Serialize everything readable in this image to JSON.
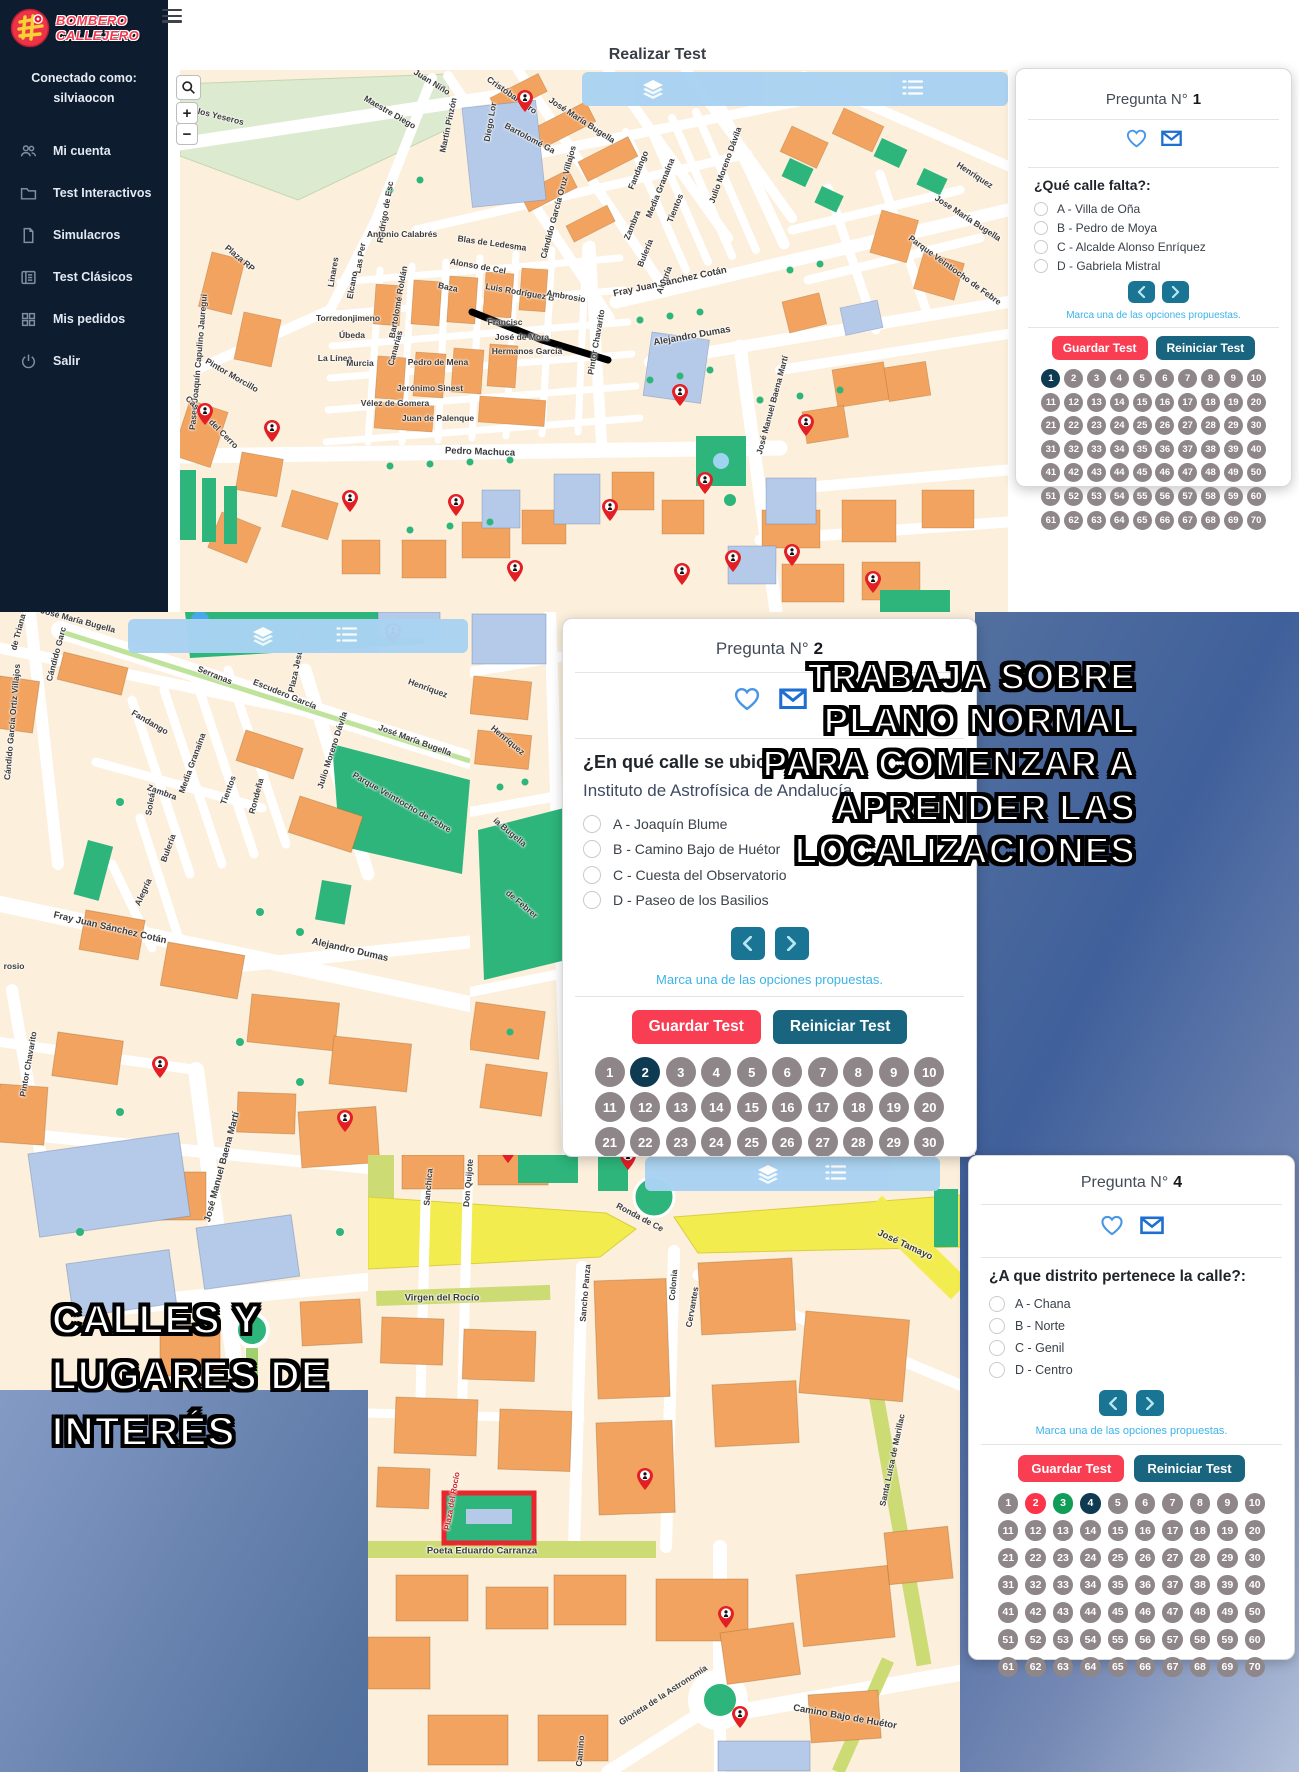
{
  "app": {
    "brand": {
      "line1": "BOMBERO",
      "line2": "CALLEJERO"
    },
    "sidebar": {
      "connected_label": "Conectado como:",
      "username": "silviaocon",
      "menu": [
        {
          "icon": "users",
          "label": "Mi cuenta"
        },
        {
          "icon": "folder",
          "label": "Test Interactivos"
        },
        {
          "icon": "file",
          "label": "Simulacros"
        },
        {
          "icon": "listalt",
          "label": "Test Clásicos"
        },
        {
          "icon": "grid",
          "label": "Mis pedidos"
        },
        {
          "icon": "power",
          "label": "Salir"
        }
      ]
    },
    "header": {
      "title": "Realizar Test"
    }
  },
  "labels": {
    "title_prefix": "Pregunta N°",
    "hint": "Marca una de las opciones propuestas.",
    "save": "Guardar Test",
    "reset": "Reiniciar Test"
  },
  "questions": {
    "q1": {
      "number": "1",
      "question": "¿Qué calle falta?:",
      "options": [
        "A - Villa de Oña",
        "B - Pedro de Moya",
        "C - Alcalde Alonso Enríquez",
        "D - Gabriela Mistral"
      ],
      "grid": {
        "total": 70,
        "states": {
          "1": "current"
        }
      }
    },
    "q2": {
      "number": "2",
      "question": "¿En qué calle se ubica?:",
      "subject": "Instituto de Astrofísica de Andalucía",
      "options": [
        "A - Joaquín Blume",
        "B - Camino Bajo de Huétor",
        "C - Cuesta del Observatorio",
        "D - Paseo de los Basilios"
      ],
      "grid": {
        "total": 70,
        "states": {
          "2": "current"
        }
      }
    },
    "q4": {
      "number": "4",
      "question": "¿A que distrito pertenece la calle?:",
      "options": [
        "A - Chana",
        "B - Norte",
        "C - Genil",
        "D - Centro"
      ],
      "grid": {
        "total": 70,
        "states": {
          "2": "wrong",
          "3": "correct",
          "4": "current"
        }
      }
    }
  },
  "overlays": {
    "trabaja": [
      "TRABAJA SOBRE",
      "PLANO NORMAL",
      "PARA COMENZAR A",
      "APRENDER LAS",
      "LOCALIZACIONES"
    ],
    "calles": [
      "CALLES Y",
      "LUGARES DE",
      "INTERÉS"
    ]
  },
  "colors": {
    "sidebar_bg": "#0e1c30",
    "brand_red": "#f23b50",
    "toolbar_blue": "#a9d3f2",
    "button_red": "#f93e53",
    "button_teal": "#19647e",
    "arrow_teal": "#1a7493",
    "bubble_gray": "#8e8689",
    "bubble_current": "#0e3a52",
    "bubble_wrong": "#fb3449",
    "bubble_correct": "#0f9d58",
    "hint_blue": "#3cb3e8",
    "icon_blue": "#1e6fd0"
  },
  "maps": {
    "top": {
      "labels": [
        {
          "t": "de los Yeseros",
          "x": 35,
          "y": 45,
          "r": 14
        },
        {
          "t": "Juan Niño",
          "x": 252,
          "y": 12,
          "r": 32
        },
        {
          "t": "Maestre Diego",
          "x": 210,
          "y": 42,
          "r": 30
        },
        {
          "t": "Martín Pinzón",
          "x": 268,
          "y": 55,
          "r": -78
        },
        {
          "t": "Cristóbal Caro",
          "x": 332,
          "y": 25,
          "r": 35
        },
        {
          "t": "Diego Lor",
          "x": 310,
          "y": 52,
          "r": -80
        },
        {
          "t": "Bartolomé Ga",
          "x": 350,
          "y": 68,
          "r": 28
        },
        {
          "t": "José María Bugella",
          "x": 402,
          "y": 50,
          "r": 33
        },
        {
          "t": "Cándido García Oruz Villajos",
          "x": 378,
          "y": 132,
          "r": -75
        },
        {
          "t": "Jose María Bugella",
          "x": 788,
          "y": 148,
          "r": 33
        },
        {
          "t": "Henríquez",
          "x": 795,
          "y": 105,
          "r": 33
        },
        {
          "t": "Parque Veintiocho de Febre",
          "x": 775,
          "y": 200,
          "r": 36
        },
        {
          "t": "Julio Moreno Dávila",
          "x": 545,
          "y": 95,
          "r": -70
        },
        {
          "t": "Fandango",
          "x": 458,
          "y": 100,
          "r": -68
        },
        {
          "t": "Media Granaína",
          "x": 480,
          "y": 118,
          "r": -68
        },
        {
          "t": "Tientos",
          "x": 495,
          "y": 138,
          "r": -68
        },
        {
          "t": "Zambra",
          "x": 452,
          "y": 155,
          "r": -68
        },
        {
          "t": "Bulería",
          "x": 465,
          "y": 183,
          "r": -68
        },
        {
          "t": "Alegría",
          "x": 484,
          "y": 210,
          "r": -68
        },
        {
          "t": "Rodrigo de Esc",
          "x": 205,
          "y": 142,
          "r": -80
        },
        {
          "t": "Antonio Calabrés",
          "x": 222,
          "y": 164,
          "r": 0
        },
        {
          "t": "Blas de Ledesma",
          "x": 312,
          "y": 173,
          "r": 8
        },
        {
          "t": "Alonso de Cel",
          "x": 298,
          "y": 196,
          "r": 10
        },
        {
          "t": "Baza",
          "x": 268,
          "y": 217,
          "r": 12
        },
        {
          "t": "Luis Rodríguez B",
          "x": 340,
          "y": 222,
          "r": 10
        },
        {
          "t": "Ambrosio",
          "x": 386,
          "y": 226,
          "r": 10
        },
        {
          "t": "Francisc",
          "x": 325,
          "y": 252,
          "r": 0
        },
        {
          "t": "José de Mora",
          "x": 342,
          "y": 267,
          "r": 0
        },
        {
          "t": "Hermanos García",
          "x": 347,
          "y": 281,
          "r": 0
        },
        {
          "t": "Las Per",
          "x": 180,
          "y": 188,
          "r": -80
        },
        {
          "t": "Linares",
          "x": 153,
          "y": 202,
          "r": -80
        },
        {
          "t": "Elcano",
          "x": 172,
          "y": 215,
          "r": -80
        },
        {
          "t": "Bartolomé Roldán",
          "x": 218,
          "y": 232,
          "r": -80
        },
        {
          "t": "Torredonjimeno",
          "x": 168,
          "y": 248,
          "r": 0
        },
        {
          "t": "Úbeda",
          "x": 172,
          "y": 265,
          "r": 0
        },
        {
          "t": "La Línea",
          "x": 155,
          "y": 288,
          "r": 0
        },
        {
          "t": "Murcia",
          "x": 180,
          "y": 293,
          "r": 0
        },
        {
          "t": "Canarias",
          "x": 215,
          "y": 278,
          "r": -75
        },
        {
          "t": "Pedro de Mena",
          "x": 258,
          "y": 292,
          "r": 0
        },
        {
          "t": "Jerónimo Sinest",
          "x": 250,
          "y": 318,
          "r": 0
        },
        {
          "t": "Vélez de Gomera",
          "x": 215,
          "y": 333,
          "r": 0
        },
        {
          "t": "Juan de Palenque",
          "x": 258,
          "y": 348,
          "r": 0
        },
        {
          "t": "Pintor Chavarito",
          "x": 416,
          "y": 272,
          "r": -80
        },
        {
          "t": "Fray Juan Sánchez Cotán",
          "x": 490,
          "y": 212,
          "r": -12,
          "s": 9.5
        },
        {
          "t": "Alejandro Dumas",
          "x": 512,
          "y": 266,
          "r": -10,
          "s": 9.5
        },
        {
          "t": "Pedro Machuca",
          "x": 300,
          "y": 382,
          "r": 2,
          "s": 9.5
        },
        {
          "t": "José Manuel Baena Martí",
          "x": 592,
          "y": 335,
          "r": -75
        },
        {
          "t": "Paseo Joaquín Capulino Jauregui",
          "x": 18,
          "y": 292,
          "r": -85
        },
        {
          "t": "Pintor Morcillo",
          "x": 52,
          "y": 305,
          "r": 30
        },
        {
          "t": "Casería del Cerro",
          "x": 32,
          "y": 352,
          "r": 45
        },
        {
          "t": "Plaza RP",
          "x": 60,
          "y": 188,
          "r": 40
        }
      ],
      "markers": [
        [
          345,
          42
        ],
        [
          25,
          355
        ],
        [
          92,
          372
        ],
        [
          170,
          442
        ],
        [
          276,
          446
        ],
        [
          430,
          451
        ],
        [
          500,
          336
        ],
        [
          525,
          424
        ],
        [
          626,
          366
        ],
        [
          335,
          512
        ],
        [
          502,
          515
        ],
        [
          553,
          502
        ],
        [
          612,
          496
        ],
        [
          693,
          523
        ]
      ]
    },
    "left": {
      "labels": [
        {
          "t": "José María Bugella",
          "x": 78,
          "y": 8,
          "r": 15
        },
        {
          "t": "de Triana",
          "x": 18,
          "y": 20,
          "r": -75
        },
        {
          "t": "Cándido García Ortiz Villajos",
          "x": 12,
          "y": 110,
          "r": -85
        },
        {
          "t": "Cándido Garc",
          "x": 56,
          "y": 42,
          "r": -75
        },
        {
          "t": "Serranas",
          "x": 215,
          "y": 63,
          "r": 22
        },
        {
          "t": "Escudero García",
          "x": 285,
          "y": 82,
          "r": 22
        },
        {
          "t": "Plaza Jesús de la",
          "x": 298,
          "y": 46,
          "r": -78
        },
        {
          "t": "Henríquez",
          "x": 428,
          "y": 76,
          "r": 20
        },
        {
          "t": "Fandango",
          "x": 150,
          "y": 110,
          "r": 30
        },
        {
          "t": "Media Granaína",
          "x": 192,
          "y": 151,
          "r": -70
        },
        {
          "t": "Tientos",
          "x": 228,
          "y": 178,
          "r": -70
        },
        {
          "t": "Zambra",
          "x": 162,
          "y": 180,
          "r": 20
        },
        {
          "t": "Rondeña",
          "x": 256,
          "y": 184,
          "r": -75
        },
        {
          "t": "Julio Moreno Dávila",
          "x": 332,
          "y": 138,
          "r": -72
        },
        {
          "t": "José María Bugella",
          "x": 415,
          "y": 128,
          "r": 20
        },
        {
          "t": "Parque Veintiocho de Febre",
          "x": 402,
          "y": 190,
          "r": 30
        },
        {
          "t": "Soleá",
          "x": 150,
          "y": 192,
          "r": -80
        },
        {
          "t": "Bulería",
          "x": 168,
          "y": 236,
          "r": -70
        },
        {
          "t": "Alegría",
          "x": 143,
          "y": 280,
          "r": -65
        },
        {
          "t": "Fray Juan Sánchez Cotán",
          "x": 110,
          "y": 316,
          "r": 13,
          "s": 9.5
        },
        {
          "t": "Alejandro Dumas",
          "x": 350,
          "y": 338,
          "r": 13,
          "s": 9.5
        },
        {
          "t": "rosio",
          "x": 14,
          "y": 354,
          "r": 0
        },
        {
          "t": "Pintor Chavarito",
          "x": 28,
          "y": 452,
          "r": -80
        },
        {
          "t": "José Manuel Baena Martí",
          "x": 222,
          "y": 555,
          "r": -75,
          "s": 9.5
        }
      ],
      "markers": [
        [
          393,
          33
        ],
        [
          160,
          466
        ],
        [
          345,
          520
        ]
      ]
    },
    "cstrip": {
      "labels": [
        {
          "t": "Henríquez",
          "x": 38,
          "y": 128,
          "r": 40
        },
        {
          "t": "ía Bugella",
          "x": 40,
          "y": 220,
          "r": 40
        },
        {
          "t": "de Febrer",
          "x": 52,
          "y": 292,
          "r": 40
        }
      ],
      "markers": []
    },
    "bottom": {
      "labels": [
        {
          "t": "Ronda de Ce",
          "x": 272,
          "y": 62,
          "r": 28
        },
        {
          "t": "José Tamayo",
          "x": 537,
          "y": 90,
          "r": 25,
          "s": 9.5
        },
        {
          "t": "Sanchica",
          "x": 60,
          "y": 32,
          "r": -85
        },
        {
          "t": "Don Quijote",
          "x": 100,
          "y": 28,
          "r": -85
        },
        {
          "t": "Sancho Panza",
          "x": 217,
          "y": 138,
          "r": -85
        },
        {
          "t": "Colonia",
          "x": 305,
          "y": 130,
          "r": -85
        },
        {
          "t": "Cervantes",
          "x": 324,
          "y": 152,
          "r": -80
        },
        {
          "t": "Virgen del Rocío",
          "x": 74,
          "y": 143,
          "r": 0,
          "s": 9.5
        },
        {
          "t": "Plaza del Rocío",
          "x": 84,
          "y": 346,
          "r": -80,
          "c": "#cc2222",
          "s": 8
        },
        {
          "t": "Poeta Eduardo Carranza",
          "x": 114,
          "y": 396,
          "r": 0,
          "s": 9.5
        },
        {
          "t": "Santa Luisa de Marillac",
          "x": 524,
          "y": 305,
          "r": -78
        },
        {
          "t": "Glorieta de la Astronomía",
          "x": 295,
          "y": 540,
          "r": -33
        },
        {
          "t": "Camino Bajo de Huétor",
          "x": 477,
          "y": 562,
          "r": 10,
          "s": 9.5
        },
        {
          "t": "Camino",
          "x": 212,
          "y": 596,
          "r": -85
        }
      ],
      "markers": [
        [
          140,
          8
        ],
        [
          260,
          15
        ],
        [
          277,
          335
        ],
        [
          358,
          473
        ],
        [
          372,
          573
        ]
      ]
    }
  }
}
